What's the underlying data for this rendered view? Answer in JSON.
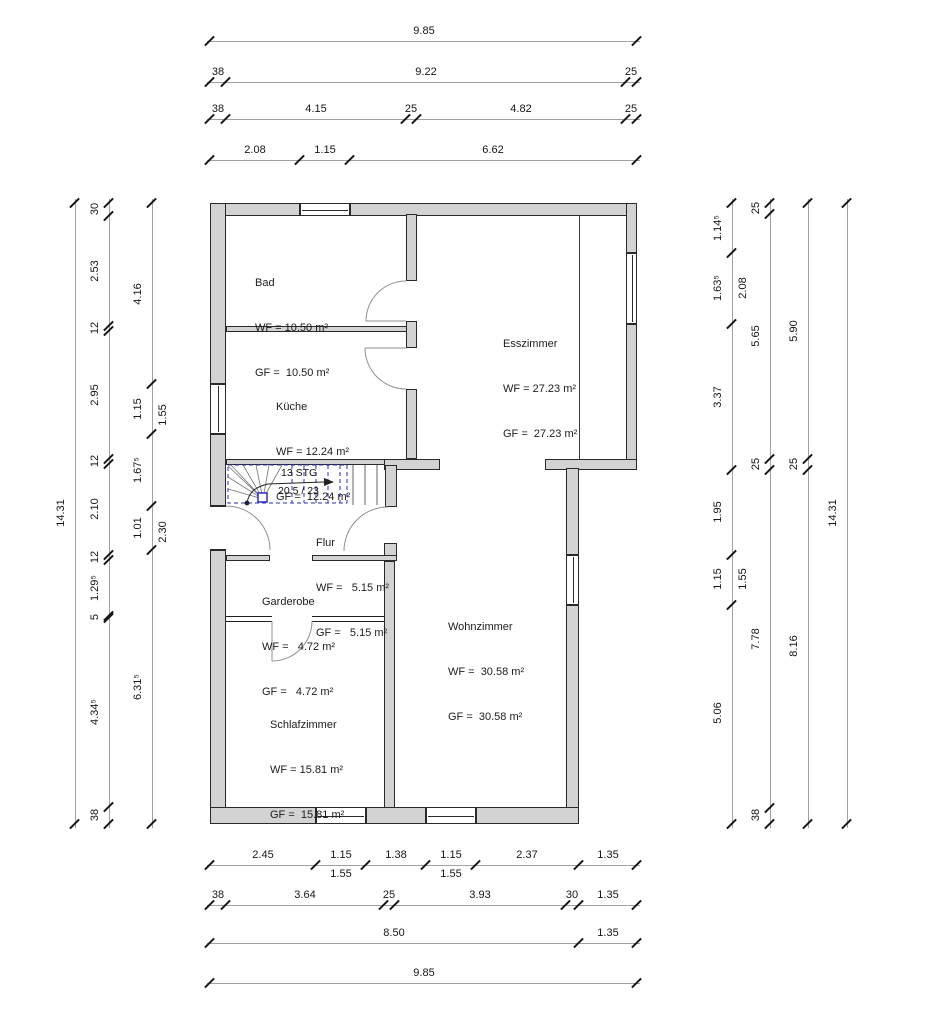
{
  "colors": {
    "wall_fill": "#d3d3d3",
    "stair_blue": "#2d2dbb"
  },
  "rooms": [
    {
      "name": "Bad",
      "wf": "WF = 10.50 m²",
      "gf": "GF =  10.50 m²"
    },
    {
      "name": "Küche",
      "wf": "WF = 12.24 m²",
      "gf": "GF =  12.24 m²"
    },
    {
      "name": "Esszimmer",
      "wf": "WF = 27.23 m²",
      "gf": "GF =  27.23 m²"
    },
    {
      "name": "Flur",
      "wf": "WF =   5.15 m²",
      "gf": "GF =   5.15 m²"
    },
    {
      "name": "Garderobe",
      "wf": "WF =   4.72 m²",
      "gf": "GF =   4.72 m²"
    },
    {
      "name": "Wohnzimmer",
      "wf": "WF =  30.58 m²",
      "gf": "GF =  30.58 m²"
    },
    {
      "name": "Schlafzimmer",
      "wf": "WF = 15.81 m²",
      "gf": "GF =  15.81 m²"
    }
  ],
  "stair": {
    "steps_label": "13 STG",
    "ratio_label": "20.5 / 23"
  },
  "dims": {
    "top": [
      {
        "labels": [
          "9.85"
        ]
      },
      {
        "labels": [
          "38",
          "9.22",
          "25"
        ]
      },
      {
        "labels": [
          "38",
          "4.15",
          "25",
          "4.82",
          "25"
        ]
      },
      {
        "labels": [
          "2.08",
          "1.15",
          "6.62"
        ]
      }
    ],
    "bottom": [
      {
        "labels": [
          "2.45",
          "1.15",
          "1.38",
          "1.15",
          "2.37",
          "1.35"
        ],
        "sub": [
          "1.55",
          "1.55"
        ]
      },
      {
        "labels": [
          "38",
          "3.64",
          "25",
          "3.93",
          "30",
          "1.35"
        ]
      },
      {
        "labels": [
          "8.50",
          "1.35"
        ]
      },
      {
        "labels": [
          "9.85"
        ]
      }
    ],
    "left": [
      {
        "labels": [
          "14.31"
        ]
      },
      {
        "labels": [
          "30",
          "2.53",
          "12",
          "2.95",
          "12",
          "2.10",
          "12",
          "1.29⁵",
          "5",
          "4.34⁵",
          "38"
        ]
      },
      {
        "labels": [
          "4.16",
          "1.15",
          "1.67⁵",
          "1.01",
          "6.31⁵"
        ],
        "sub": [
          "1.55",
          "2.30"
        ]
      }
    ],
    "right": [
      {
        "labels": [
          "1.14⁵",
          "1.63⁵",
          "3.37",
          "1.95",
          "1.15",
          "5.06"
        ],
        "sub": [
          "2.08",
          "1.55"
        ]
      },
      {
        "labels": [
          "25",
          "5.65",
          "25",
          "7.78",
          "38"
        ]
      },
      {
        "labels": [
          "5.90",
          "25",
          "8.16"
        ]
      },
      {
        "labels": [
          "14.31"
        ]
      }
    ]
  }
}
